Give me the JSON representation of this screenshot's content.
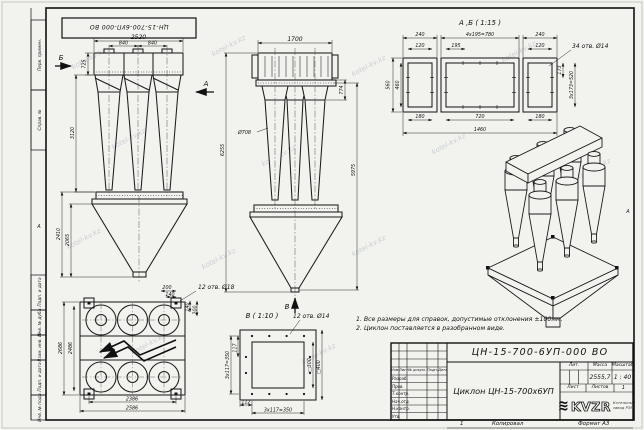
{
  "page": {
    "watermark": "kotel-kv.kz",
    "zone_letter": "А",
    "sheet_mark": "1",
    "copied_label": "Копировал",
    "format_label": "Формат А3"
  },
  "top_stamp": {
    "designation": "ЦН-15-700-6УП-000 ВО"
  },
  "margin": {
    "labels": [
      "Перв. примен.",
      "Справ. №",
      "Подп. и дата",
      "Инв. № дубл.",
      "Взам. инв. №",
      "Подп. и дата",
      "Инв. № подл."
    ]
  },
  "notes": {
    "line1": "1. Все размеры для справок, допустимые отклонения ±100мм.",
    "line2": "2. Циклон поставляется в разобранном виде."
  },
  "views": {
    "front": {
      "dim_width_top": "2520",
      "dim_pitch_1": "840",
      "dim_pitch_2": "840",
      "dim_box_h": "725",
      "dim_cyclone_h": "3120",
      "dim_hopper_h1": "2410",
      "dim_hopper_h2": "2065",
      "arrow_b": "Б",
      "arrow_a": "А"
    },
    "side": {
      "dim_width_top": "1700",
      "dim_774": "774",
      "dim_diameter": "Ø708",
      "dim_total_h": "6255",
      "dim_h2": "5975",
      "arrow_v": "В"
    },
    "plan": {
      "dim_left_outer": "2686",
      "dim_left_inner": "2486",
      "dim_bottom_inner": "2386",
      "dim_bottom_outer": "2586",
      "dim_200_top": "200",
      "dim_140_top": "140",
      "dim_140_right": "140",
      "dim_200_right": "200",
      "holes_note": "12 отв. Ø18"
    },
    "v_detail": {
      "title": "В ( 1:10 )",
      "holes_note": "12 отв. Ø14",
      "dim_117": "117",
      "dim_pitch_left": "3х117=350",
      "dim_112": "112",
      "dim_pitch_bottom": "3х117=350",
      "dim_sq300": "□300",
      "dim_sq400": "□400"
    },
    "ab_detail": {
      "title": "А ,Б ( 1:15 )",
      "dim_240_l": "240",
      "dim_120_l": "120",
      "dim_pitch_top": "4х195=780",
      "dim_195": "195",
      "dim_240_r": "240",
      "dim_120_r": "120",
      "holes_note": "34 отв. Ø14",
      "dim_560": "560",
      "dim_460": "460",
      "dim_173": "173",
      "dim_pitch_right": "3х173=520",
      "dim_180_l": "180",
      "dim_720": "720",
      "dim_180_r": "180",
      "dim_1460": "1460"
    }
  },
  "title_block": {
    "designation": "ЦН-15-700-6УП-000 ВО",
    "product_name": "Циклон ЦН-15-700х6УП",
    "header": {
      "izm": "Изм.",
      "list": "Лист",
      "doc": "№ докум.",
      "sign": "Подп.",
      "date": "Дата"
    },
    "rows": [
      "Разраб.",
      "Пров.",
      "Т.контр.",
      "Нач.отд.",
      "Н.контр.",
      "Утв."
    ],
    "lit_label": "Лит.",
    "mass_label": "Масса",
    "scale_label": "Масштаб",
    "mass_value": "2555,7",
    "scale_value": "1 : 40",
    "sheet_label": "Лист",
    "sheets_label": "Листов",
    "sheets_value": "1",
    "logo_text": "KVZR",
    "company_line1": "Котельный",
    "company_line2": "завод РЭП"
  }
}
